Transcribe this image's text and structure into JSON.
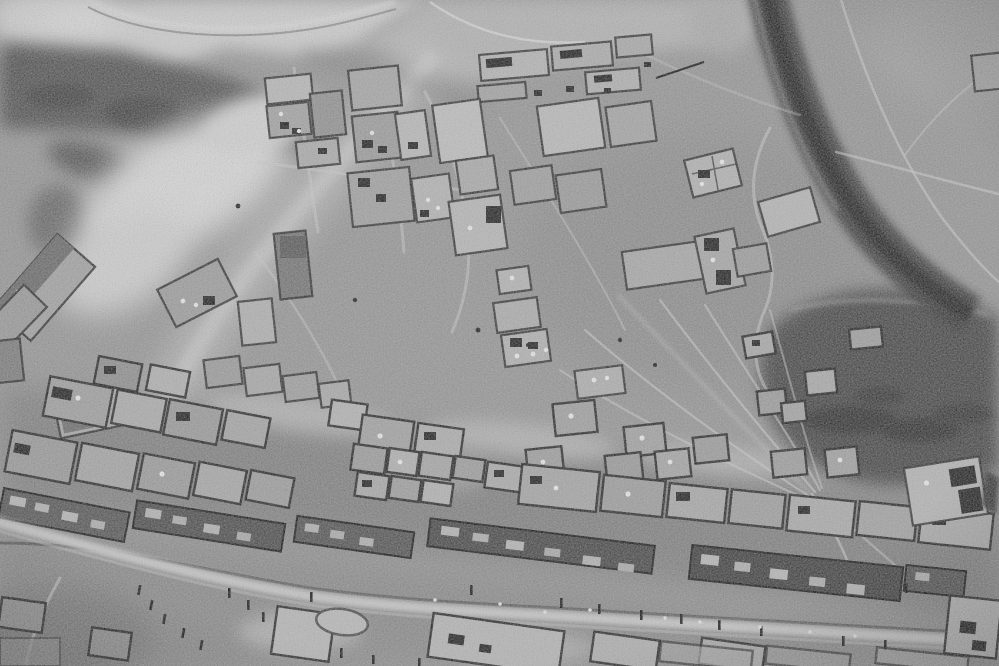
{
  "meta": {
    "content_type": "photograph",
    "subject": "Black-and-white aerial reconnaissance photograph of a desert village of walled courtyard compounds",
    "color_mode": "grayscale",
    "visible_text": "none"
  },
  "palette": {
    "plain": "#969696",
    "crest_light": "#cccccc",
    "ridge_dark": "#555555",
    "wash_bright": "#d8d8d8",
    "highway_dark": "#3a3a3a",
    "highway_core": "#2c2c2c",
    "hill_dark": "#4a4a4a",
    "wall_dark": "#2b2b2b",
    "street_light": "#c4c4c4",
    "terrace_row_dark": "#4e4e4e",
    "track_light": "#cacaca",
    "compound_fill_light": "#b6b6b6",
    "compound_fill_mid": "#a0a0a0"
  },
  "scene": {
    "regions": [
      {
        "name": "ridge-northwest",
        "description": "light hill crest with dark scrub-covered slope"
      },
      {
        "name": "sand-wash-west",
        "description": "bright sandy wash basin below the ridge"
      },
      {
        "name": "barracks-row-north",
        "description": "row of long rectangular buildings at the top center"
      },
      {
        "name": "compound-grid-north",
        "description": "loose grid of walled enclosures, some with small dark buildings and white roofs"
      },
      {
        "name": "highway-northeast",
        "description": "dark curved road descending from the top edge toward the right edge"
      },
      {
        "name": "open-plain-east",
        "description": "gray plain crossed by faint light tracks"
      },
      {
        "name": "track-fan-southeast",
        "description": "fan of pale tracks converging toward the village edge"
      },
      {
        "name": "dark-hill-southeast",
        "description": "dark rocky rise in the lower right"
      },
      {
        "name": "village-band-south",
        "description": "dense diagonal band of courtyard houses and long dark terrace rows"
      },
      {
        "name": "main-street-south",
        "description": "light main street lined with trees, small figures and corrals"
      }
    ],
    "feature_counts": {
      "walled_compounds_north": 34,
      "walled_compounds_south": 40,
      "terrace_rows": 6,
      "roads": 2,
      "light_tracks": 16
    }
  }
}
